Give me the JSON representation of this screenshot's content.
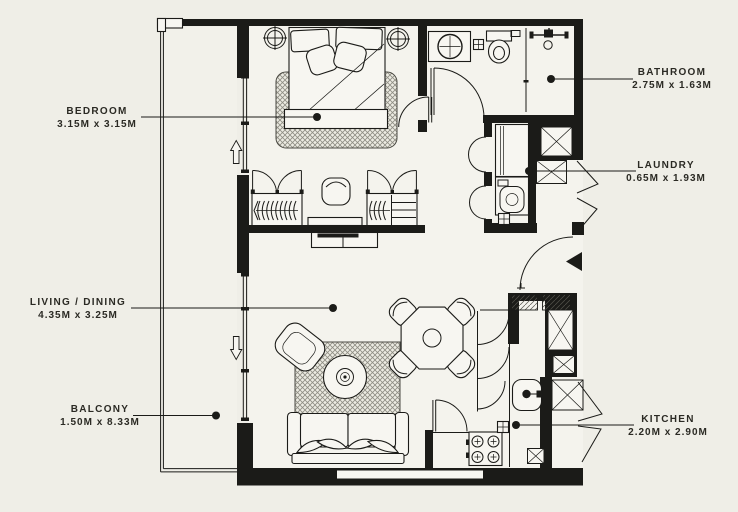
{
  "document": {
    "kind": "apartment floor plan"
  },
  "colors": {
    "background": "#efeee7",
    "ink": "#1b1b18",
    "label_text": "#2b2a24"
  },
  "labels": [
    {
      "id": "bedroom",
      "name": "BEDROOM",
      "dimensions": "3.15M x 3.15M"
    },
    {
      "id": "bathroom",
      "name": "BATHROOM",
      "dimensions": "2.75M x 1.63M"
    },
    {
      "id": "laundry",
      "name": "LAUNDRY",
      "dimensions": "0.65M x 1.93M"
    },
    {
      "id": "living_dining",
      "name": "LIVING / DINING",
      "dimensions": "4.35M x 3.25M"
    },
    {
      "id": "balcony",
      "name": "BALCONY",
      "dimensions": "1.50M x 8.33M"
    },
    {
      "id": "kitchen",
      "name": "KITCHEN",
      "dimensions": "2.20M x 2.90M"
    }
  ]
}
